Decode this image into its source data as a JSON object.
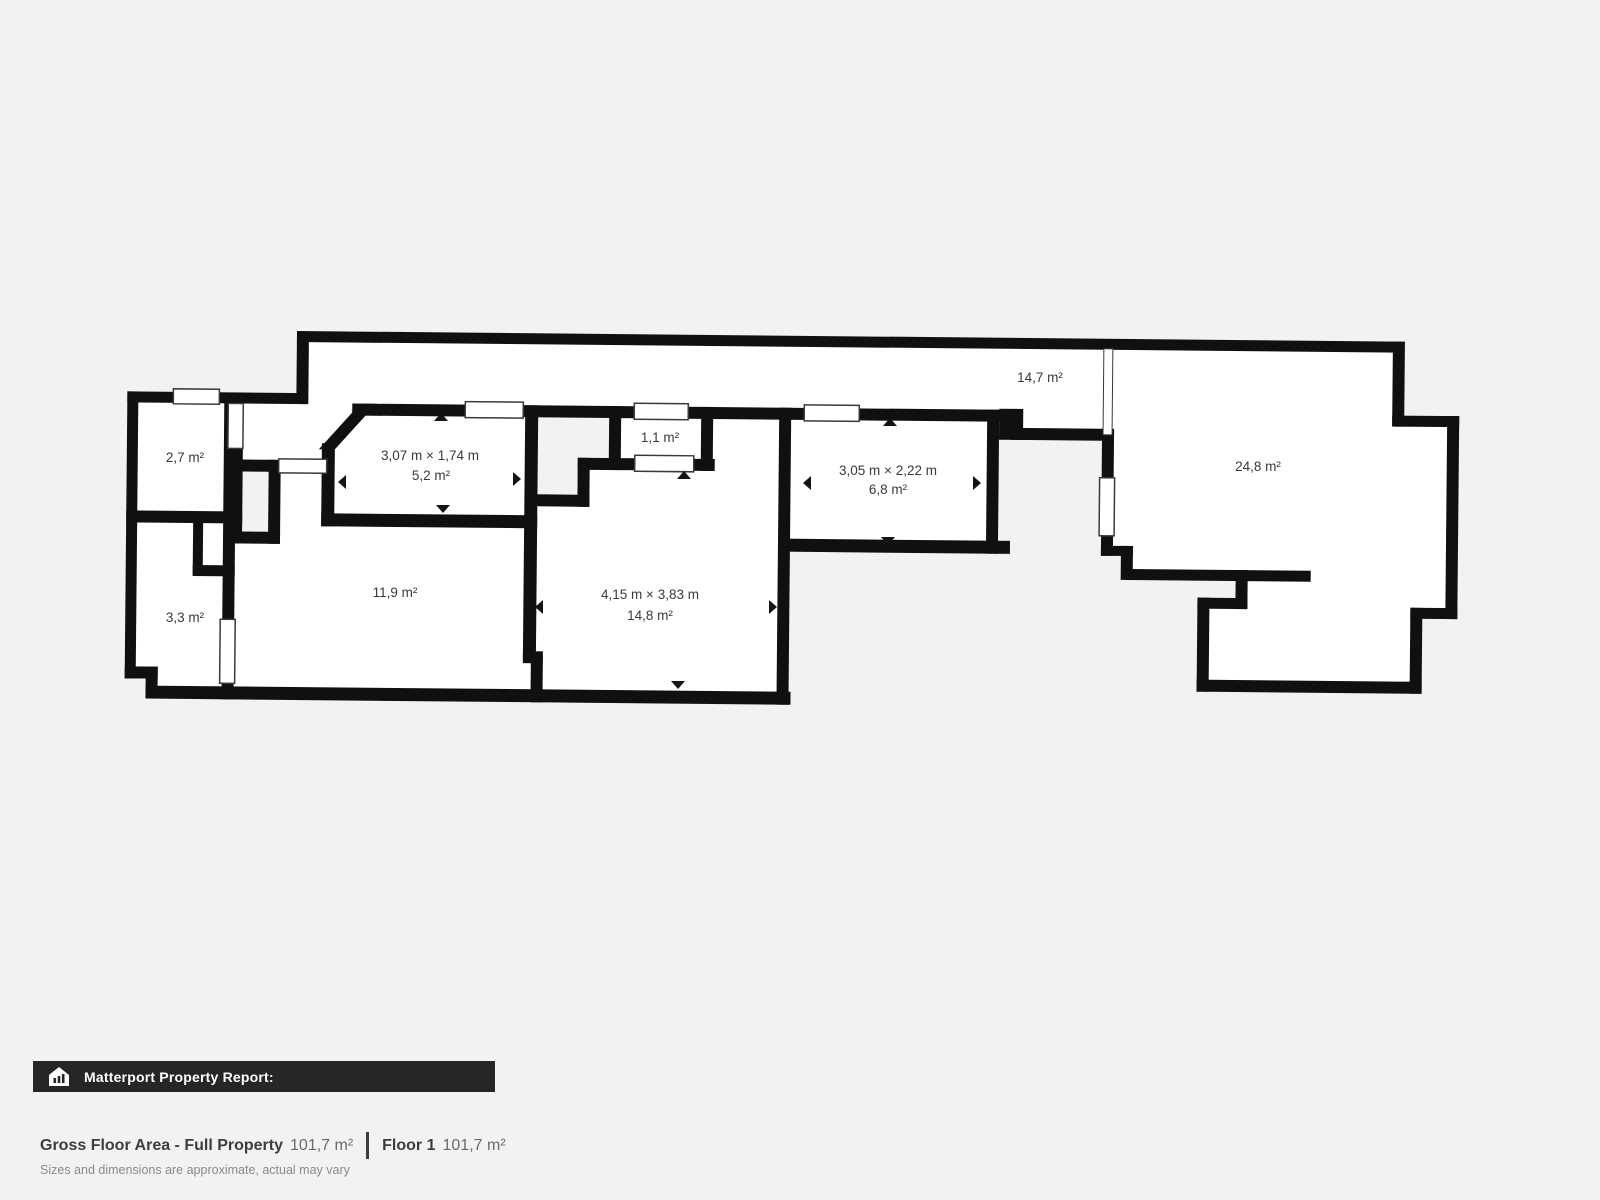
{
  "page": {
    "background": "#f4f2f1"
  },
  "floorplan": {
    "wall_color": "#101010",
    "room_fill": "#ffffff",
    "rooms": [
      {
        "id": "room-2-7",
        "area_label": "2,7 m²"
      },
      {
        "id": "room-3-3",
        "area_label": "3,3 m²"
      },
      {
        "id": "room-5-2",
        "dim_label": "3,07 m × 1,74 m",
        "area_label": "5,2 m²"
      },
      {
        "id": "room-11-9",
        "area_label": "11,9 m²"
      },
      {
        "id": "room-1-1",
        "area_label": "1,1 m²"
      },
      {
        "id": "room-14-8",
        "dim_label": "4,15 m × 3,83 m",
        "area_label": "14,8 m²"
      },
      {
        "id": "room-6-8",
        "dim_label": "3,05 m × 2,22 m",
        "area_label": "6,8 m²"
      },
      {
        "id": "hallway-14-7",
        "area_label": "14,7 m²"
      },
      {
        "id": "room-24-8",
        "area_label": "24,8 m²"
      }
    ]
  },
  "report_banner": {
    "icon": "matterport-house-icon",
    "title": "Matterport Property Report:",
    "background": "#262626",
    "text_color": "#ffffff"
  },
  "summary": {
    "gross_label": "Gross Floor Area - Full Property",
    "gross_value": "101,7 m²",
    "floor_label": "Floor 1",
    "floor_value": "101,7 m²",
    "disclaimer": "Sizes and dimensions are approximate, actual may vary"
  }
}
